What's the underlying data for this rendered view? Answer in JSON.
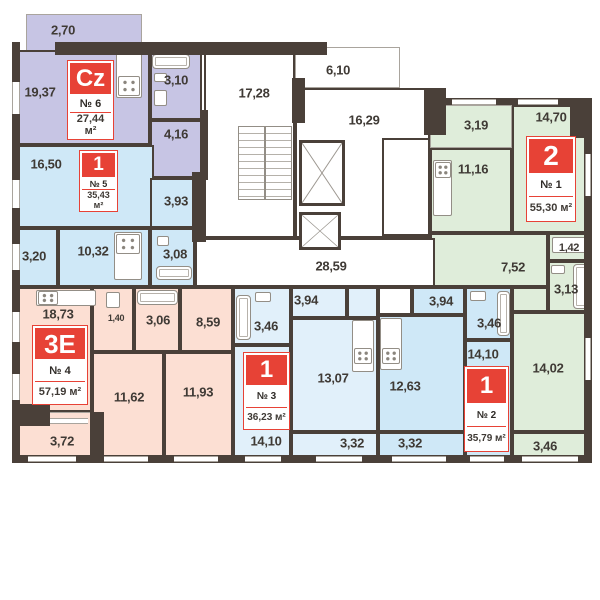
{
  "plan_name": "Residential floor plan",
  "colors": {
    "wall": "#4a4039",
    "accent_red": "#e74236",
    "apt_purple": "#c7c5e4",
    "apt_blue": "#cfe8f7",
    "apt_light_blue": "#e1f0fa",
    "apt_peach": "#fcdfd3",
    "apt_green": "#dfedda"
  },
  "apartments": [
    {
      "id": "6",
      "color": "#c7c5e4",
      "badge": {
        "type": "Cz",
        "number": "№ 6",
        "area": "27,44 м²"
      },
      "rooms": [
        {
          "name": "balcony",
          "area": "2,70"
        },
        {
          "name": "living-room",
          "area": "19,37"
        },
        {
          "name": "bathroom",
          "area": "3,10"
        },
        {
          "name": "hallway",
          "area": "4,16"
        }
      ]
    },
    {
      "id": "5",
      "color": "#cfe8f7",
      "badge": {
        "type": "1",
        "number": "№ 5",
        "area": "35,43 м²"
      },
      "rooms": [
        {
          "name": "room",
          "area": "16,50"
        },
        {
          "name": "hallway",
          "area": "3,93"
        },
        {
          "name": "balcony",
          "area": "3,20"
        },
        {
          "name": "kitchen",
          "area": "10,32"
        },
        {
          "name": "bathroom",
          "area": "3,08"
        }
      ]
    },
    {
      "id": "4",
      "color": "#fcdfd3",
      "badge": {
        "type": "3E",
        "number": "№ 4",
        "area": "57,19 м²"
      },
      "rooms": [
        {
          "name": "kitchen-living",
          "area": "18,73"
        },
        {
          "name": "wc",
          "area": "1,40"
        },
        {
          "name": "bathroom",
          "area": "3,06"
        },
        {
          "name": "hallway",
          "area": "8,59"
        },
        {
          "name": "room",
          "area": "11,62"
        },
        {
          "name": "room",
          "area": "11,93"
        },
        {
          "name": "balcony",
          "area": "3,72"
        }
      ]
    },
    {
      "id": "3",
      "color": "#e1f0fa",
      "badge": {
        "type": "1",
        "number": "№ 3",
        "area": "36,23 м²"
      },
      "rooms": [
        {
          "name": "bathroom",
          "area": "3,46"
        },
        {
          "name": "hallway",
          "area": "3,94"
        },
        {
          "name": "kitchen-living",
          "area": "13,07"
        },
        {
          "name": "room",
          "area": "14,10"
        },
        {
          "name": "balcony",
          "area": "3,32"
        }
      ]
    },
    {
      "id": "2",
      "color": "#cfe8f7",
      "badge": {
        "type": "1",
        "number": "№ 2",
        "area": "35,79 м²"
      },
      "rooms": [
        {
          "name": "hallway",
          "area": "3,94"
        },
        {
          "name": "bathroom",
          "area": "3,46"
        },
        {
          "name": "kitchen",
          "area": "12,63"
        },
        {
          "name": "room",
          "area": "14,10"
        },
        {
          "name": "balcony",
          "area": "3,32"
        }
      ]
    },
    {
      "id": "1",
      "color": "#dfedda",
      "badge": {
        "type": "2",
        "number": "№ 1",
        "area": "55,30 м²"
      },
      "rooms": [
        {
          "name": "balcony",
          "area": "3,19"
        },
        {
          "name": "kitchen",
          "area": "11,16"
        },
        {
          "name": "room",
          "area": "14,70"
        },
        {
          "name": "hallway",
          "area": "7,52"
        },
        {
          "name": "storage",
          "area": "1,42"
        },
        {
          "name": "bathroom",
          "area": "3,13"
        },
        {
          "name": "room",
          "area": "14,02"
        },
        {
          "name": "balcony",
          "area": "3,46"
        }
      ]
    }
  ],
  "common": {
    "stairs": "17,28",
    "terrace": "6,10",
    "lobby": "16,29",
    "corridor": "28,59"
  }
}
